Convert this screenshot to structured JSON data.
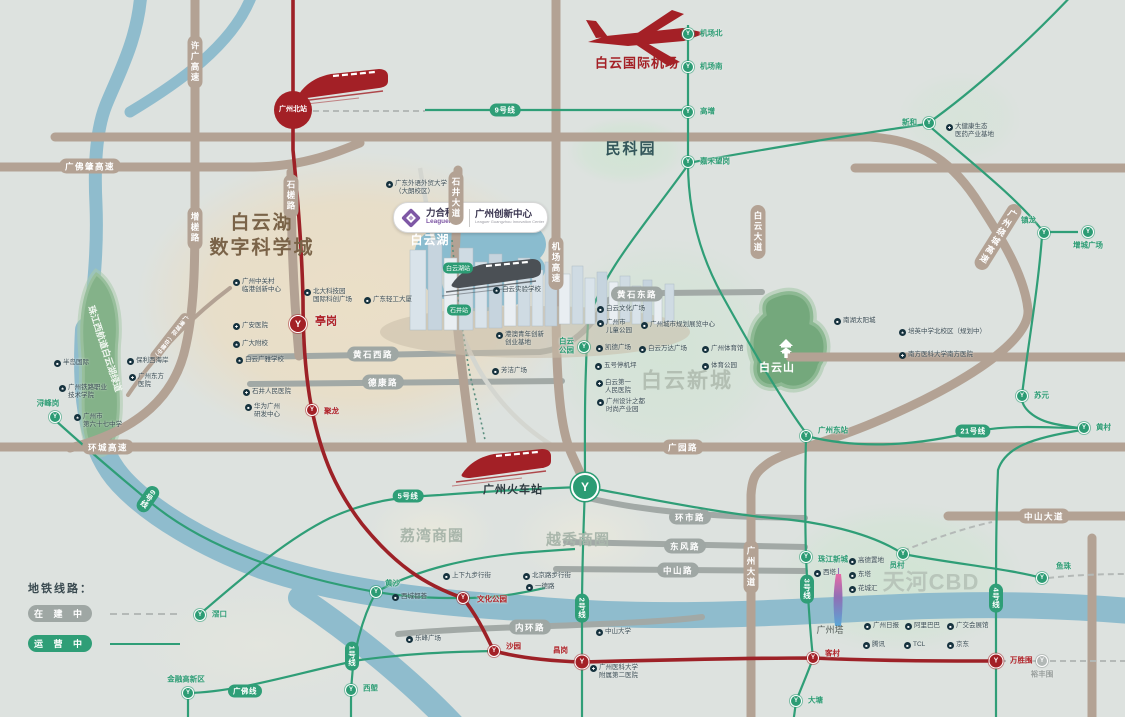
{
  "colors": {
    "metro_green": "#2f9e77",
    "line8_red": "#9d2127",
    "road_tan": "#b3a294",
    "road_gray": "#9fa7a4",
    "river_blue": "#8fbccd",
    "brand_purple": "#7e57a5",
    "brand_red": "#a42026",
    "background": "#dde2df"
  },
  "legend": {
    "title": "地铁线路：",
    "under_construction": "在 建 中",
    "in_operation": "运 营 中"
  },
  "logo": {
    "brand": "力合科创",
    "brand_en": "Leaguer",
    "project": "广州创新中心",
    "project_en": "Leaguer Guangzhou Innovation Center"
  },
  "zones": [
    {
      "text": "白云湖\n数字科学城",
      "x": 262,
      "y": 236,
      "size": 19,
      "color": "#7a6348",
      "ls": 2
    },
    {
      "text": "民科园",
      "x": 631,
      "y": 149,
      "size": 15,
      "color": "#33565a",
      "ls": 2
    },
    {
      "text": "白云新城",
      "x": 687,
      "y": 381,
      "size": 21,
      "color": "#b3bfb3",
      "ls": 2
    },
    {
      "text": "天河CBD",
      "x": 931,
      "y": 583,
      "size": 22,
      "color": "#b8c5ba",
      "ls": 1
    },
    {
      "text": "荔湾商圈",
      "x": 432,
      "y": 536,
      "size": 15,
      "color": "#a9b6ab",
      "ls": 1
    },
    {
      "text": "越秀商圈",
      "x": 578,
      "y": 540,
      "size": 15,
      "color": "#a9b6ab",
      "ls": 1
    },
    {
      "text": "白云湖",
      "x": 430,
      "y": 241,
      "size": 12,
      "color": "#ffffff",
      "ls": 1
    },
    {
      "text": "白云山",
      "x": 777,
      "y": 368,
      "size": 11,
      "color": "#ffffff",
      "ls": 1
    },
    {
      "text": "珠江西航道白云湖绿道",
      "x": 104,
      "y": 349,
      "size": 9,
      "color": "#eef5ee",
      "rotate": 72
    },
    {
      "text": "白云国际机场",
      "x": 637,
      "y": 64,
      "size": 13,
      "color": "#a42026",
      "ls": 1
    },
    {
      "text": "广州火车站",
      "x": 513,
      "y": 490,
      "size": 11,
      "color": "#2e3a40",
      "ls": 1
    },
    {
      "text": "广州塔",
      "x": 830,
      "y": 631,
      "size": 9,
      "color": "#555d5a",
      "weight": 400
    }
  ],
  "roads": [
    {
      "label": "许广高速",
      "x": 195,
      "y": 62,
      "v": 1
    },
    {
      "label": "增槎路",
      "x": 195,
      "y": 228,
      "v": 1
    },
    {
      "label": "广佛肇高速",
      "x": 90,
      "y": 166
    },
    {
      "label": "环城高速",
      "x": 108,
      "y": 447
    },
    {
      "label": "广园路",
      "x": 683,
      "y": 447
    },
    {
      "label": "机场高速",
      "x": 556,
      "y": 263,
      "v": 1
    },
    {
      "label": "石井大道",
      "x": 456,
      "y": 198,
      "v": 1
    },
    {
      "label": "石槎路",
      "x": 291,
      "y": 196,
      "v": 1
    },
    {
      "label": "白云大道",
      "x": 758,
      "y": 232,
      "v": 1
    },
    {
      "label": "广州大道",
      "x": 751,
      "y": 567,
      "v": 1
    },
    {
      "label": "广州绕城高速",
      "x": 998,
      "y": 237,
      "v": 1,
      "rotate": 32
    },
    {
      "label": "中山大道",
      "x": 1044,
      "y": 516
    },
    {
      "label": "黄石西路",
      "x": 373,
      "y": 354,
      "gray": 1
    },
    {
      "label": "黄石东路",
      "x": 637,
      "y": 294,
      "gray": 1
    },
    {
      "label": "德康路",
      "x": 383,
      "y": 382,
      "gray": 1
    },
    {
      "label": "环市路",
      "x": 690,
      "y": 517,
      "gray": 1
    },
    {
      "label": "东风路",
      "x": 685,
      "y": 546,
      "gray": 1
    },
    {
      "label": "中山路",
      "x": 678,
      "y": 570,
      "gray": 1
    },
    {
      "label": "内环路",
      "x": 530,
      "y": 627,
      "gray": 1
    },
    {
      "label": "广清城际（在建中）",
      "x": 170,
      "y": 337,
      "v": 1,
      "rotate": 38,
      "small": 1
    }
  ],
  "line_pills": [
    {
      "label": "9号线",
      "x": 505,
      "y": 110
    },
    {
      "label": "5号线",
      "x": 408,
      "y": 496
    },
    {
      "label": "6号线",
      "x": 148,
      "y": 499,
      "v": 1,
      "rotate": 35
    },
    {
      "label": "1号线",
      "x": 352,
      "y": 656,
      "v": 1
    },
    {
      "label": "2号线",
      "x": 582,
      "y": 608,
      "v": 1
    },
    {
      "label": "3号线",
      "x": 807,
      "y": 589,
      "v": 1
    },
    {
      "label": "4号线",
      "x": 996,
      "y": 598,
      "v": 1
    },
    {
      "label": "21号线",
      "x": 973,
      "y": 431
    },
    {
      "label": "广佛线",
      "x": 245,
      "y": 691
    }
  ],
  "stations": [
    {
      "label": "机场北",
      "x": 688,
      "y": 34,
      "lx": 700,
      "ly": 34
    },
    {
      "label": "机场南",
      "x": 688,
      "y": 67,
      "lx": 700,
      "ly": 67
    },
    {
      "label": "高增",
      "x": 688,
      "y": 112,
      "lx": 700,
      "ly": 112
    },
    {
      "label": "嘉禾望岗",
      "x": 688,
      "y": 162,
      "lx": 700,
      "ly": 162
    },
    {
      "label": "新和",
      "x": 929,
      "y": 123,
      "lx": 917,
      "ly": 123,
      "align": "r"
    },
    {
      "label": "镇龙",
      "x": 1044,
      "y": 233,
      "lx": 1036,
      "ly": 221,
      "align": "r"
    },
    {
      "label": "增城广场",
      "x": 1088,
      "y": 232,
      "lx": 1088,
      "ly": 246,
      "align": "c"
    },
    {
      "label": "苏元",
      "x": 1022,
      "y": 396,
      "lx": 1034,
      "ly": 396
    },
    {
      "label": "黄村",
      "x": 1084,
      "y": 428,
      "lx": 1096,
      "ly": 428
    },
    {
      "label": "广州东站",
      "x": 806,
      "y": 436,
      "lx": 818,
      "ly": 431
    },
    {
      "label": "白云\n公园",
      "x": 584,
      "y": 347,
      "lx": 574,
      "ly": 346,
      "align": "r"
    },
    {
      "label": "浔峰岗",
      "x": 55,
      "y": 417,
      "lx": 48,
      "ly": 404,
      "align": "c"
    },
    {
      "label": "滘口",
      "x": 200,
      "y": 615,
      "lx": 212,
      "ly": 615
    },
    {
      "label": "金融高新区",
      "x": 188,
      "y": 693,
      "lx": 186,
      "ly": 680,
      "align": "c"
    },
    {
      "label": "黄沙",
      "x": 376,
      "y": 592,
      "lx": 385,
      "ly": 584
    },
    {
      "label": "西塱",
      "x": 351,
      "y": 690,
      "lx": 363,
      "ly": 689
    },
    {
      "label": "大塘",
      "x": 796,
      "y": 701,
      "lx": 808,
      "ly": 701
    },
    {
      "label": "珠江新城",
      "x": 806,
      "y": 557,
      "lx": 818,
      "ly": 560
    },
    {
      "label": "员村",
      "x": 903,
      "y": 554,
      "lx": 897,
      "ly": 566,
      "align": "c"
    },
    {
      "label": "鱼珠",
      "x": 1042,
      "y": 578,
      "lx": 1056,
      "ly": 567
    },
    {
      "label": "文化公园",
      "x": 463,
      "y": 598,
      "type": "r",
      "lx": 477,
      "ly": 600,
      "lc": "red"
    },
    {
      "label": "沙园",
      "x": 494,
      "y": 651,
      "type": "r",
      "lx": 506,
      "ly": 647,
      "lc": "red"
    },
    {
      "label": "昌岗",
      "x": 582,
      "y": 662,
      "type": "R2",
      "lx": 568,
      "ly": 651,
      "lc": "red",
      "align": "r"
    },
    {
      "label": "客村",
      "x": 813,
      "y": 658,
      "type": "r",
      "lx": 825,
      "ly": 654,
      "lc": "red"
    },
    {
      "label": "万胜围",
      "x": 996,
      "y": 661,
      "type": "R2",
      "lx": 1010,
      "ly": 661,
      "lc": "red"
    },
    {
      "label": "亭岗",
      "x": 298,
      "y": 324,
      "type": "R2",
      "big": 1,
      "lx": 315,
      "ly": 322,
      "lc": "red",
      "biglbl": 1
    },
    {
      "label": "聚龙",
      "x": 312,
      "y": 410,
      "type": "r",
      "lx": 324,
      "ly": 412,
      "lc": "red"
    },
    {
      "label": "裕丰围",
      "x": 1042,
      "y": 661,
      "type": "u",
      "lx": 1042,
      "ly": 675,
      "align": "c",
      "lc": "gray"
    },
    {
      "label": "广州北站",
      "x": 293,
      "y": 110,
      "type": "B"
    },
    {
      "label": "",
      "x": 585,
      "y": 487,
      "type": "G"
    },
    {
      "label": "白云湖站",
      "x": 458,
      "y": 268,
      "type": "cap"
    },
    {
      "label": "石井站",
      "x": 459,
      "y": 310,
      "type": "cap"
    }
  ],
  "pois": [
    {
      "icon": "b",
      "label": "半岛国际",
      "x": 58,
      "y": 363
    },
    {
      "icon": "b",
      "label": "保利西海岸",
      "x": 131,
      "y": 361
    },
    {
      "icon": "h",
      "label": "广州东方\n医院",
      "x": 133,
      "y": 377
    },
    {
      "icon": "s",
      "label": "广州铁路职业\n技术学院",
      "x": 63,
      "y": 388
    },
    {
      "icon": "s",
      "label": "广州市\n第六十七中学",
      "x": 78,
      "y": 417
    },
    {
      "icon": "s",
      "label": "广东外语外贸大学\n（大朗校区）",
      "x": 390,
      "y": 184
    },
    {
      "icon": "b",
      "label": "广州中关村\n临港创新中心",
      "x": 237,
      "y": 282
    },
    {
      "icon": "h",
      "label": "广安医院",
      "x": 237,
      "y": 326
    },
    {
      "icon": "s",
      "label": "广大附校",
      "x": 237,
      "y": 344
    },
    {
      "icon": "s",
      "label": "白云广雅学校",
      "x": 240,
      "y": 360
    },
    {
      "icon": "h",
      "label": "石井人民医院",
      "x": 247,
      "y": 392
    },
    {
      "icon": "b",
      "label": "华为广州\n研发中心",
      "x": 249,
      "y": 407
    },
    {
      "icon": "b",
      "label": "北大科技园\n国际科创广场",
      "x": 308,
      "y": 292
    },
    {
      "icon": "b",
      "label": "广东轻工大厦",
      "x": 368,
      "y": 300
    },
    {
      "icon": "s",
      "label": "白云实验学校",
      "x": 497,
      "y": 290
    },
    {
      "icon": "b",
      "label": "港澳青年创新\n创业基地",
      "x": 500,
      "y": 335
    },
    {
      "icon": "b",
      "label": "芳洁广场",
      "x": 496,
      "y": 371
    },
    {
      "icon": "b",
      "label": "白云文化广场",
      "x": 601,
      "y": 309
    },
    {
      "icon": "b",
      "label": "广州市\n儿童公园",
      "x": 601,
      "y": 323
    },
    {
      "icon": "b",
      "label": "凯德广场",
      "x": 600,
      "y": 348
    },
    {
      "icon": "b",
      "label": "五号停机坪",
      "x": 599,
      "y": 366
    },
    {
      "icon": "h",
      "label": "白云第一\n人民医院",
      "x": 600,
      "y": 383
    },
    {
      "icon": "b",
      "label": "广州设计之都\n时尚产业园",
      "x": 601,
      "y": 402
    },
    {
      "icon": "b",
      "label": "广州城市规划展览中心",
      "x": 645,
      "y": 325
    },
    {
      "icon": "b",
      "label": "白云万达广场",
      "x": 643,
      "y": 349
    },
    {
      "icon": "b",
      "label": "广州体育馆",
      "x": 706,
      "y": 349
    },
    {
      "icon": "b",
      "label": "体育公园",
      "x": 706,
      "y": 366
    },
    {
      "icon": "b",
      "label": "南湖太阳城",
      "x": 838,
      "y": 321
    },
    {
      "icon": "s",
      "label": "培英中学北校区（规划中）",
      "x": 903,
      "y": 332
    },
    {
      "icon": "h",
      "label": "南方医科大学南方医院",
      "x": 903,
      "y": 355
    },
    {
      "icon": "h",
      "label": "大健康生态\n医药产业基地",
      "x": 950,
      "y": 127
    },
    {
      "icon": "b",
      "label": "上下九步行街",
      "x": 447,
      "y": 576
    },
    {
      "icon": "b",
      "label": "北京路步行街",
      "x": 527,
      "y": 576
    },
    {
      "icon": "b",
      "label": "一德路",
      "x": 530,
      "y": 587
    },
    {
      "icon": "b",
      "label": "西城都荟",
      "x": 396,
      "y": 597
    },
    {
      "icon": "b",
      "label": "乐峰广场",
      "x": 410,
      "y": 639
    },
    {
      "icon": "s",
      "label": "中山大学",
      "x": 600,
      "y": 632
    },
    {
      "icon": "h",
      "label": "广州医科大学\n附属第二医院",
      "x": 594,
      "y": 668
    },
    {
      "icon": "b",
      "label": "西塔",
      "x": 818,
      "y": 573
    },
    {
      "icon": "b",
      "label": "高德置地",
      "x": 853,
      "y": 561
    },
    {
      "icon": "b",
      "label": "东塔",
      "x": 853,
      "y": 575
    },
    {
      "icon": "b",
      "label": "花城汇",
      "x": 853,
      "y": 589
    },
    {
      "icon": "b",
      "label": "广州日报",
      "x": 868,
      "y": 626
    },
    {
      "icon": "b",
      "label": "阿里巴巴",
      "x": 909,
      "y": 626
    },
    {
      "icon": "b",
      "label": "广交会展馆",
      "x": 951,
      "y": 626
    },
    {
      "icon": "b",
      "label": "腾讯",
      "x": 867,
      "y": 645
    },
    {
      "icon": "b",
      "label": "TCL",
      "x": 908,
      "y": 645
    },
    {
      "icon": "b",
      "label": "京东",
      "x": 951,
      "y": 645
    }
  ]
}
